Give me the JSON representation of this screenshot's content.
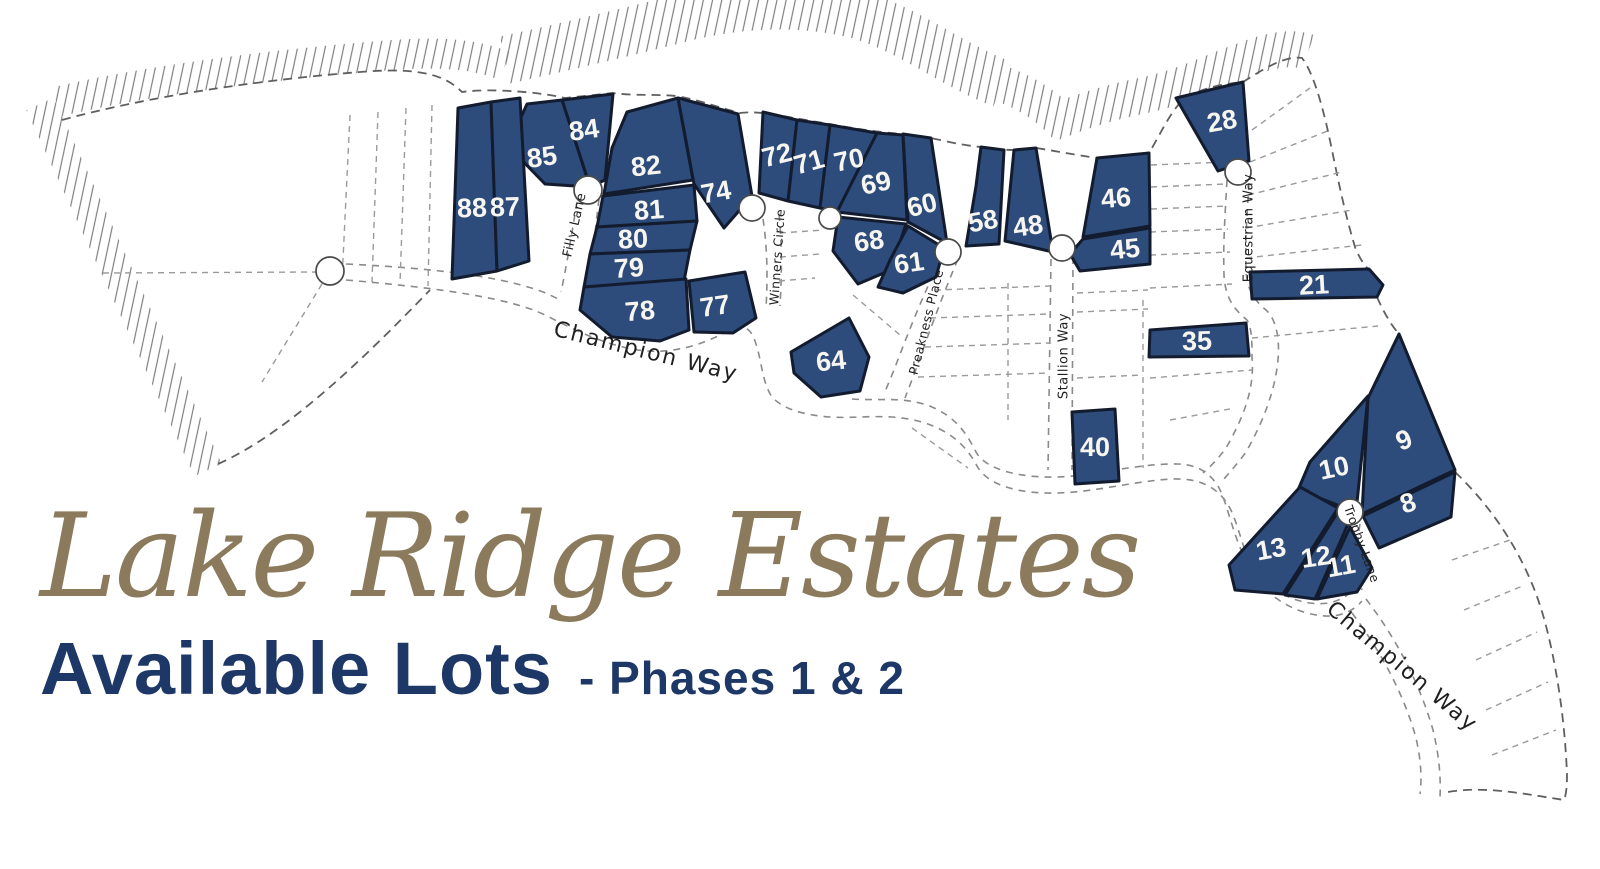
{
  "title": {
    "estate_name": "Lake Ridge Estates",
    "subtitle": "Available Lots",
    "phase": "- Phases 1 & 2"
  },
  "colors": {
    "lot_fill": "#2d4b7b",
    "lot_outline": "#131c2e",
    "lot_number_text": "#f6f5ef",
    "estate_name_tan": "#8b7a5c",
    "navy_text": "#1d3766",
    "street_text": "#1f1f1f"
  },
  "map": {
    "available_lot_numbers": [
      "84",
      "85",
      "88",
      "87",
      "82",
      "74",
      "81",
      "80",
      "79",
      "78",
      "77",
      "72",
      "71",
      "70",
      "69",
      "60",
      "68",
      "61",
      "58",
      "48",
      "46",
      "45",
      "28",
      "21",
      "35",
      "40",
      "64",
      "9",
      "10",
      "8",
      "13",
      "12",
      "11"
    ],
    "lots": [
      {
        "num": "84",
        "points": "562,100 613,94 605,180 590,187",
        "lx": 584,
        "ly": 130,
        "rot": -8
      },
      {
        "num": "85",
        "points": "527,104 562,100 590,187 545,184 508,146",
        "lx": 542,
        "ly": 157,
        "rot": -8
      },
      {
        "num": "88",
        "points": "458,108 491,102 497,271 452,279",
        "lx": 472,
        "ly": 208,
        "rot": -2
      },
      {
        "num": "87",
        "points": "491,102 520,98 529,261 497,271",
        "lx": 505,
        "ly": 207,
        "rot": -2
      },
      {
        "num": "82",
        "points": "627,112 678,98 693,180 604,194 612,148",
        "lx": 646,
        "ly": 166,
        "rot": -6
      },
      {
        "num": "74",
        "points": "678,98 738,114 752,196 724,228 694,184",
        "lx": 716,
        "ly": 192,
        "rot": -10
      },
      {
        "num": "81",
        "points": "603,196 694,185 697,221 597,227",
        "lx": 649,
        "ly": 210,
        "rot": -4
      },
      {
        "num": "80",
        "points": "597,227 697,221 690,250 590,254",
        "lx": 633,
        "ly": 239,
        "rot": -3
      },
      {
        "num": "79",
        "points": "590,254 690,250 684,281 584,287",
        "lx": 629,
        "ly": 268,
        "rot": -4
      },
      {
        "num": "78",
        "points": "584,287 686,279 689,330 660,341 612,337 580,310",
        "lx": 640,
        "ly": 311,
        "rot": -5
      },
      {
        "num": "77",
        "points": "689,281 745,272 756,318 733,333 694,332",
        "lx": 715,
        "ly": 306,
        "rot": -8
      },
      {
        "num": "72",
        "points": "763,112 797,120 788,201 759,193",
        "lx": 777,
        "ly": 155,
        "rot": -14
      },
      {
        "num": "71",
        "points": "797,120 830,125 820,208 788,201",
        "lx": 809,
        "ly": 162,
        "rot": -16
      },
      {
        "num": "70",
        "points": "830,125 877,133 837,212 820,208",
        "lx": 849,
        "ly": 160,
        "rot": -12
      },
      {
        "num": "69",
        "points": "877,133 903,135 907,220 837,212",
        "lx": 876,
        "ly": 183,
        "rot": -12
      },
      {
        "num": "60",
        "points": "903,134 931,138 947,243 908,222",
        "lx": 922,
        "ly": 205,
        "rot": -14
      },
      {
        "num": "68",
        "points": "838,217 906,224 891,270 858,284 833,251",
        "lx": 869,
        "ly": 241,
        "rot": -8
      },
      {
        "num": "61",
        "points": "908,226 944,248 936,277 903,293 878,287 890,260",
        "lx": 909,
        "ly": 263,
        "rot": -8
      },
      {
        "num": "58",
        "points": "981,147 1004,150 999,244 966,246 976,186",
        "lx": 983,
        "ly": 221,
        "rot": -10
      },
      {
        "num": "48",
        "points": "1014,150 1036,148 1053,252 1040,249 1005,241",
        "lx": 1028,
        "ly": 226,
        "rot": -8
      },
      {
        "num": "46",
        "points": "1097,158 1149,153 1150,226 1083,237",
        "lx": 1116,
        "ly": 198,
        "rot": -5
      },
      {
        "num": "45",
        "points": "1083,239 1150,228 1150,264 1080,271 1070,254",
        "lx": 1125,
        "ly": 249,
        "rot": -6
      },
      {
        "num": "28",
        "points": "1176,98 1243,82 1249,161 1218,171",
        "lx": 1222,
        "ly": 121,
        "rot": -10
      },
      {
        "num": "21",
        "points": "1250,272 1369,269 1383,285 1377,297 1252,299",
        "lx": 1314,
        "ly": 285,
        "rot": -3
      },
      {
        "num": "35",
        "points": "1150,330 1246,323 1249,356 1149,357",
        "lx": 1197,
        "ly": 341,
        "rot": -2
      },
      {
        "num": "40",
        "points": "1072,412 1115,409 1119,481 1075,484",
        "lx": 1095,
        "ly": 447,
        "rot": 0
      },
      {
        "num": "64",
        "points": "849,318 869,357 860,391 821,397 794,373 791,352",
        "lx": 831,
        "ly": 361,
        "rot": -6
      },
      {
        "num": "9",
        "points": "1399,334 1455,470 1362,514 1368,398",
        "lx": 1404,
        "ly": 440,
        "rot": -22
      },
      {
        "num": "10",
        "points": "1368,396 1356,512 1298,490 1310,462",
        "lx": 1334,
        "ly": 468,
        "rot": -12
      },
      {
        "num": "8",
        "points": "1363,516 1455,472 1451,517 1379,548",
        "lx": 1408,
        "ly": 503,
        "rot": -18
      },
      {
        "num": "13",
        "points": "1300,487 1338,508 1283,594 1235,590 1229,565",
        "lx": 1271,
        "ly": 549,
        "rot": -10
      },
      {
        "num": "12",
        "points": "1338,512 1348,524 1315,599 1285,595",
        "lx": 1316,
        "ly": 557,
        "rot": -8
      },
      {
        "num": "11",
        "points": "1350,527 1372,568 1357,592 1317,599",
        "lx": 1341,
        "ly": 566,
        "rot": -10
      }
    ],
    "streets": [
      {
        "label": "Filly Lane",
        "x": 575,
        "y": 225,
        "rot": -77,
        "size": 13,
        "spacing": 0.5
      },
      {
        "label": "Winners Circle",
        "x": 777,
        "y": 257,
        "rot": -86,
        "size": 12.5,
        "spacing": 0.5
      },
      {
        "label": "Preakness Place",
        "x": 926,
        "y": 322,
        "rot": -76,
        "size": 12.5,
        "spacing": 0.5
      },
      {
        "label": "Stallion Way",
        "x": 1064,
        "y": 356,
        "rot": -90,
        "size": 13,
        "spacing": 0.5
      },
      {
        "label": "Equestrian Way",
        "x": 1249,
        "y": 228,
        "rot": -90,
        "size": 13,
        "spacing": 0.5
      },
      {
        "label": "Trophy Lane",
        "x": 1362,
        "y": 544,
        "rot": 70,
        "size": 12.5,
        "spacing": 0.5
      },
      {
        "label": "Champion Way",
        "x": 646,
        "y": 352,
        "rot": 14,
        "size": 22,
        "spacing": 2
      },
      {
        "label": "Champion Way",
        "x": 1402,
        "y": 667,
        "rot": 40,
        "size": 22,
        "spacing": 2
      }
    ],
    "culdesacs": [
      {
        "name": "champion-way-west-end",
        "x": 330,
        "y": 271,
        "r": 14
      },
      {
        "name": "filly-lane-end",
        "x": 588,
        "y": 190,
        "r": 14
      },
      {
        "name": "winners-circle-end",
        "x": 752,
        "y": 208,
        "r": 13
      },
      {
        "name": "winners-circle-court",
        "x": 830,
        "y": 218,
        "r": 11
      },
      {
        "name": "preakness-place-end",
        "x": 948,
        "y": 252,
        "r": 13
      },
      {
        "name": "stallion-way-end",
        "x": 1062,
        "y": 248,
        "r": 13
      },
      {
        "name": "equestrian-way-end",
        "x": 1238,
        "y": 172,
        "r": 13
      },
      {
        "name": "trophy-lane-end",
        "x": 1350,
        "y": 512,
        "r": 13
      }
    ]
  }
}
